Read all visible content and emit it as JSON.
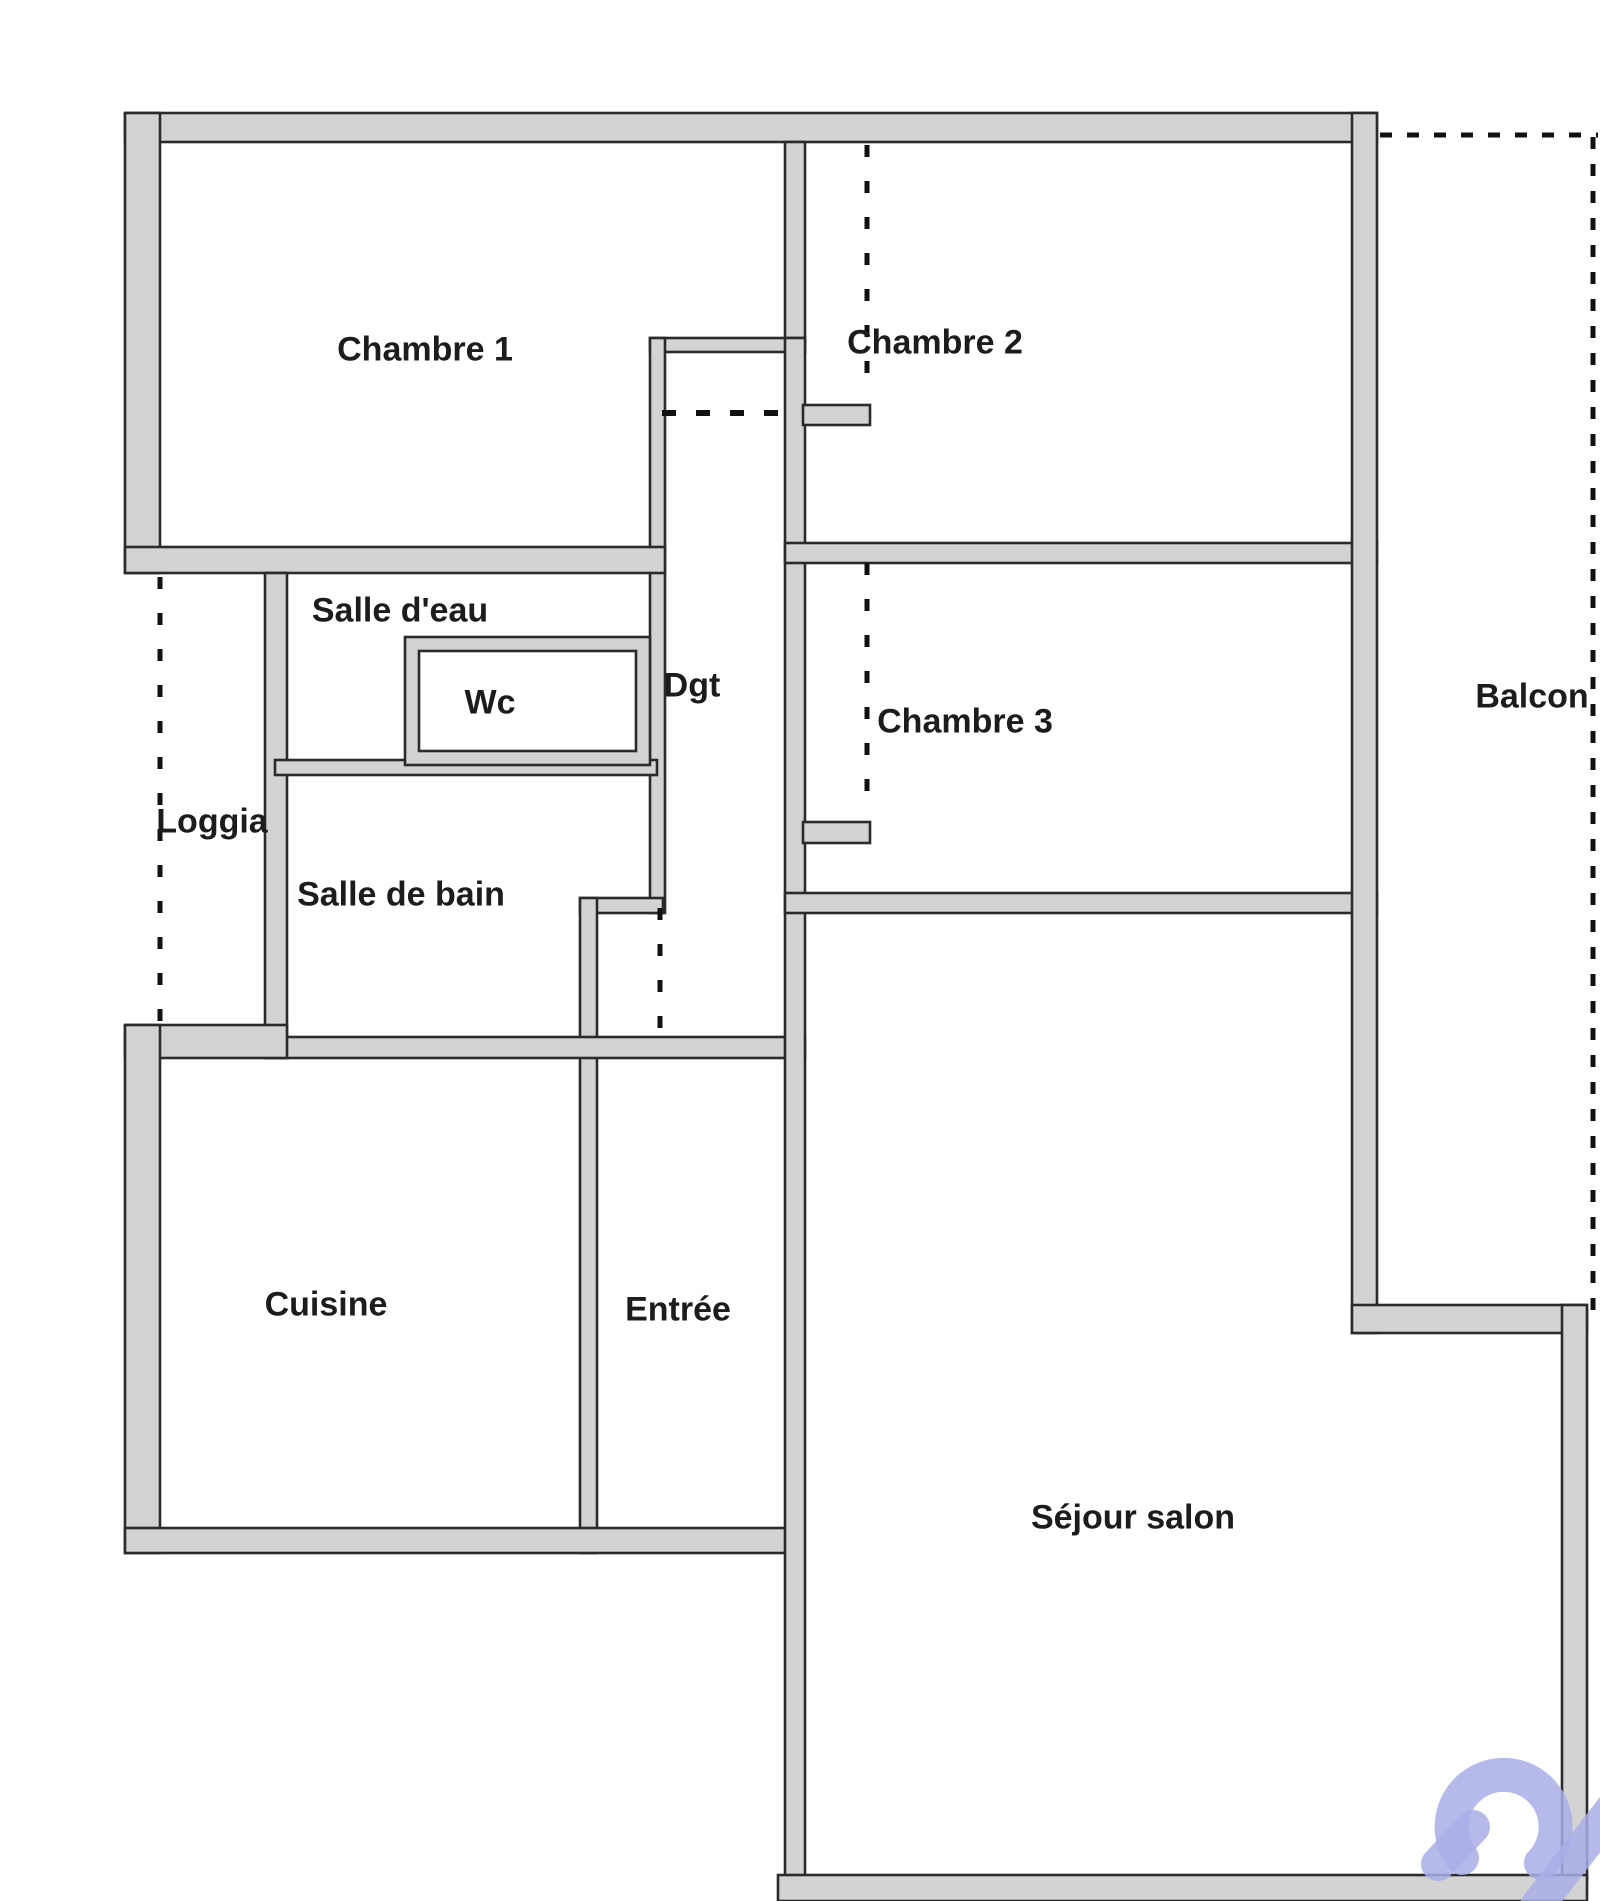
{
  "plan_type": "apartment-floor-plan",
  "rooms": {
    "chambre1": "Chambre 1",
    "chambre2": "Chambre 2",
    "chambre3": "Chambre 3",
    "salle_deau": "Salle d'eau",
    "wc": "Wc",
    "dgt": "Dgt",
    "loggia": "Loggia",
    "salle_de_bain": "Salle de bain",
    "cuisine": "Cuisine",
    "entree": "Entrée",
    "sejour_salon": "Séjour salon",
    "balcon": "Balcon"
  },
  "colors": {
    "background": "#ffffff",
    "room_fill": "#ffffff",
    "wall_fill": "#d3d3d3",
    "wall_line": "#2b2b2b",
    "dash_color": "#111111",
    "watermark": "#a9aee8"
  }
}
